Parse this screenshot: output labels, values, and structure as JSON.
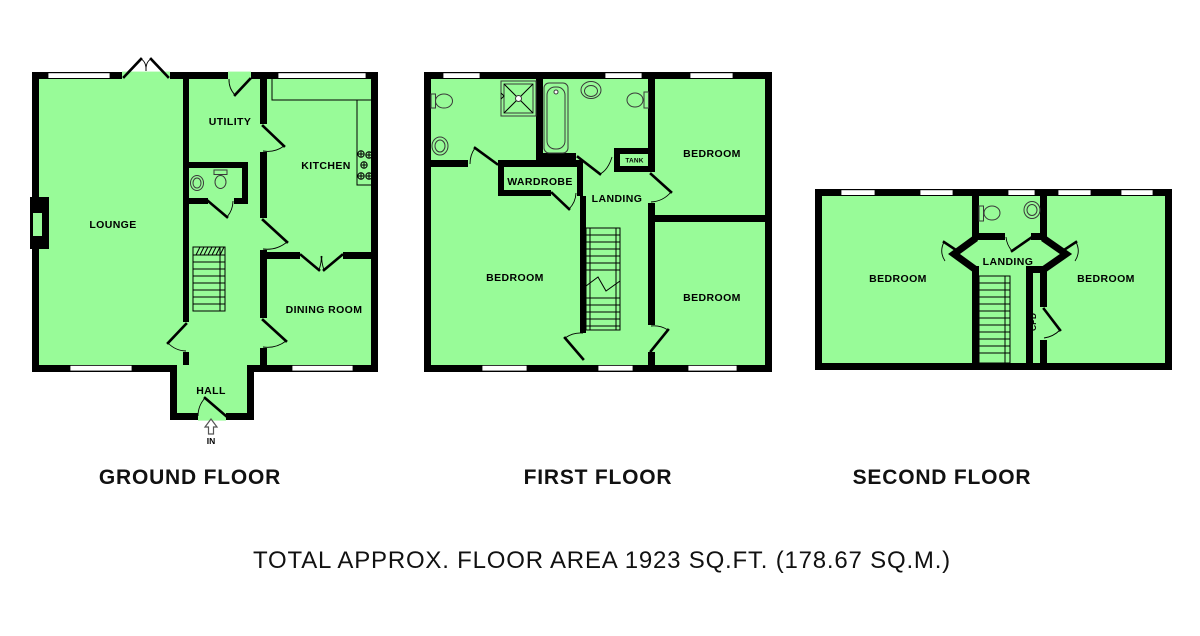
{
  "footer": {
    "total_area_label": "TOTAL APPROX. FLOOR AREA 1923 SQ.FT. (178.67 SQ.M.)"
  },
  "floors": {
    "ground": {
      "title": "GROUND FLOOR",
      "rooms": {
        "lounge": "LOUNGE",
        "utility": "UTILITY",
        "kitchen": "KITCHEN",
        "dining_room": "DINING ROOM",
        "hall": "HALL"
      },
      "entrance_label": "IN"
    },
    "first": {
      "title": "FIRST FLOOR",
      "rooms": {
        "bedroom_left": "BEDROOM",
        "bedroom_top_right": "BEDROOM",
        "bedroom_bottom_right": "BEDROOM",
        "landing": "LANDING",
        "wardrobe": "WARDROBE",
        "tank": "TANK"
      }
    },
    "second": {
      "title": "SECOND FLOOR",
      "rooms": {
        "bedroom_left": "BEDROOM",
        "bedroom_right": "BEDROOM",
        "landing": "LANDING",
        "cupboard": "CPD"
      }
    }
  },
  "colors": {
    "floor_fill": "#98FB98",
    "wall": "#000000",
    "window_fill": "#FFFFFF",
    "fixture_stroke": "#3a3a3a"
  }
}
